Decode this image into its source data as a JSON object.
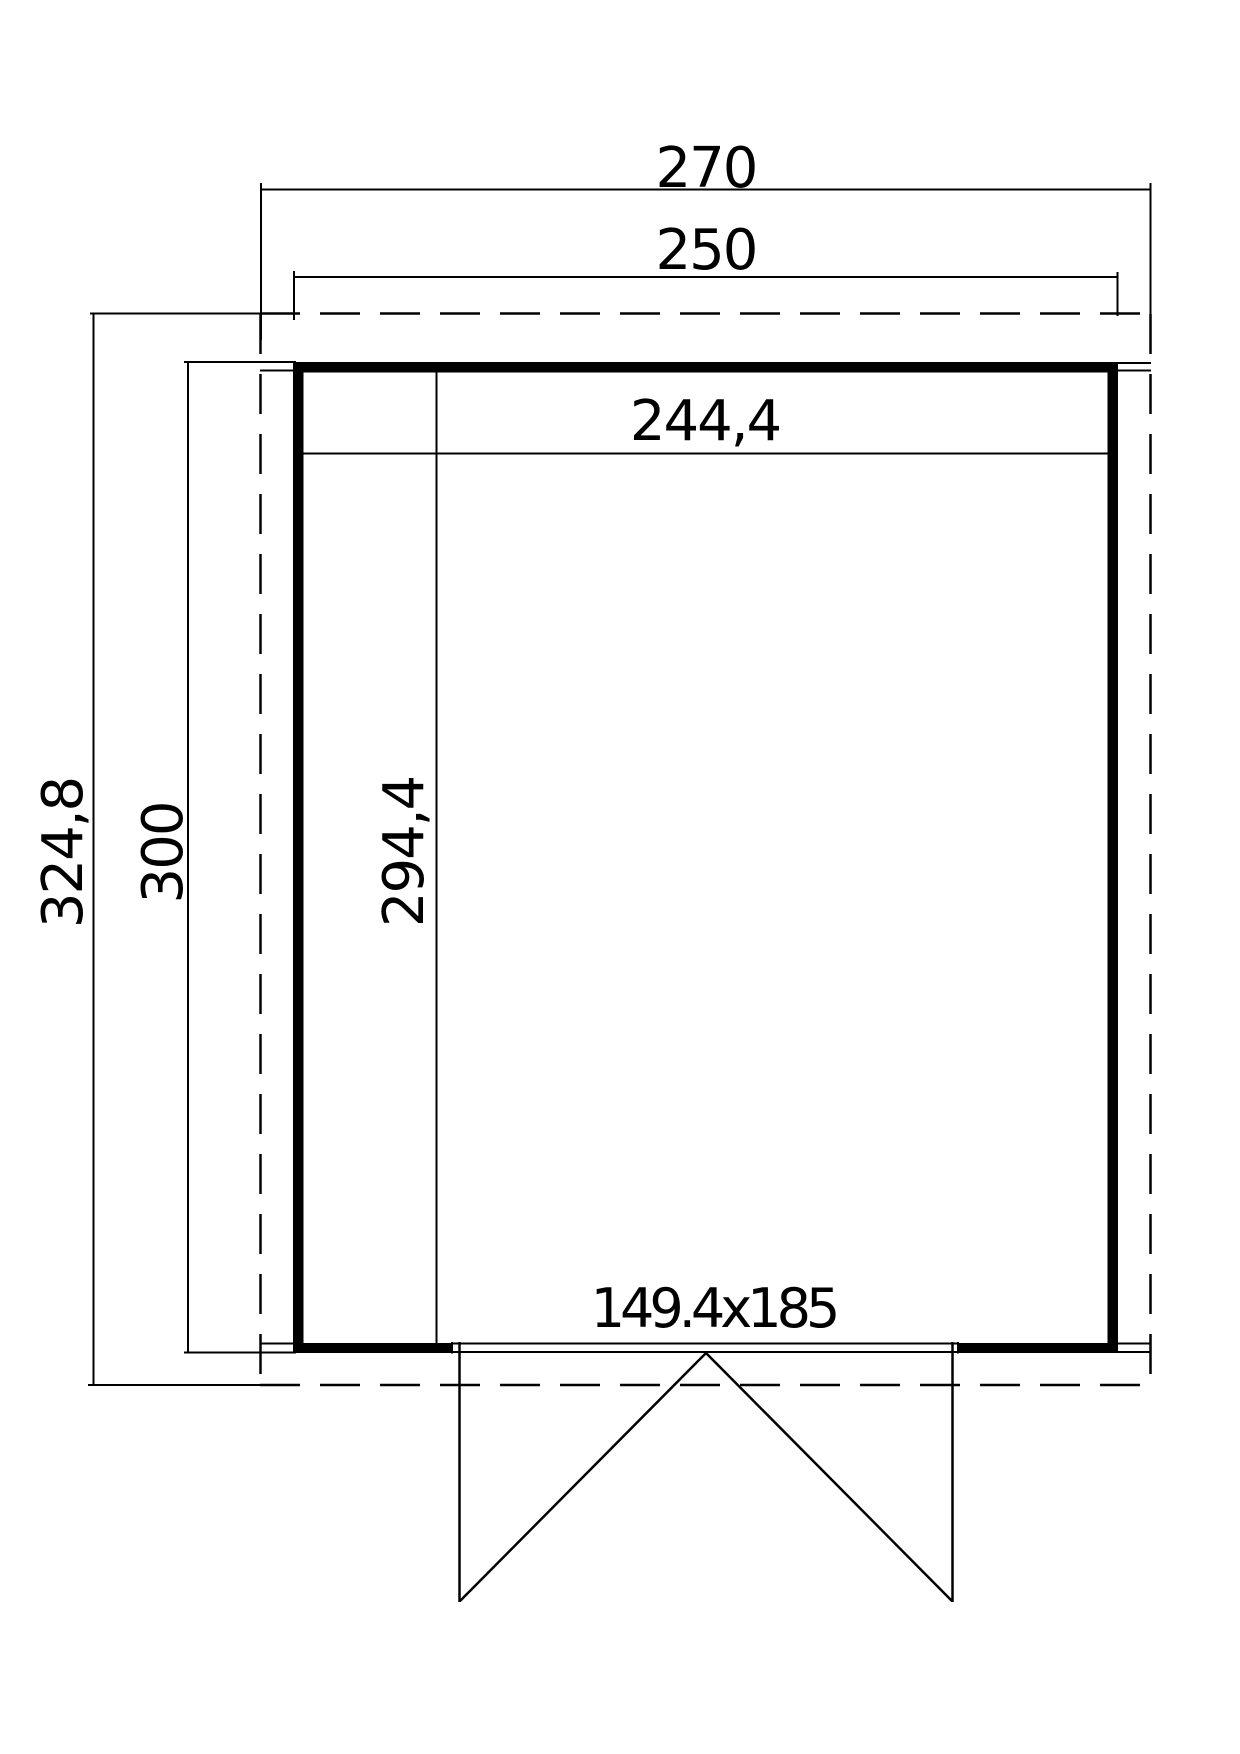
{
  "drawing": {
    "type": "shed-floor-plan",
    "colors": {
      "line": "#000000",
      "background": "#ffffff"
    },
    "dimensions": {
      "roof_width": "270",
      "base_width": "250",
      "interior_width": "244,4",
      "roof_depth": "324,8",
      "base_depth": "300",
      "interior_depth": "294,4",
      "door_size": "149.4x185"
    }
  }
}
